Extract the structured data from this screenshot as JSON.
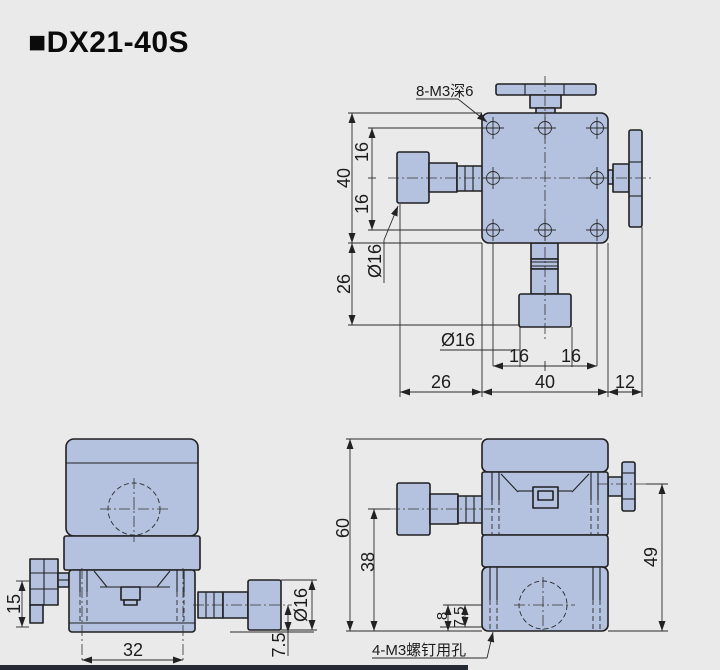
{
  "title": "■DX21-40S",
  "colors": {
    "background": "#eaeaea",
    "part_fill": "#b4c2df",
    "outline": "#202020",
    "footer_bar": "#262a33"
  },
  "views": {
    "top_view": {
      "callout_holes": "8-M3深6",
      "dims": {
        "overall_height": "40",
        "hole_pitch_upper": "16",
        "hole_pitch_lower": "16",
        "knob_left_dia": "Ø16",
        "lower_extent": "26",
        "knob_bottom_dia": "Ø16",
        "hole_pitch_left": "16",
        "hole_pitch_right": "16",
        "left_extent": "26",
        "overall_width": "40",
        "right_extent": "12"
      }
    },
    "front_view": {
      "dims": {
        "knob_height": "15",
        "base_width": "32",
        "axis_offset": "7.5",
        "knob_dia": "Ø16"
      }
    },
    "side_view": {
      "callout_screws": "4-M3螺钉用孔",
      "dims": {
        "overall_height": "60",
        "x_axis_height": "38",
        "y_axis_height": "49",
        "hole_offset_a": "8",
        "hole_offset_b": "7.5"
      }
    }
  }
}
